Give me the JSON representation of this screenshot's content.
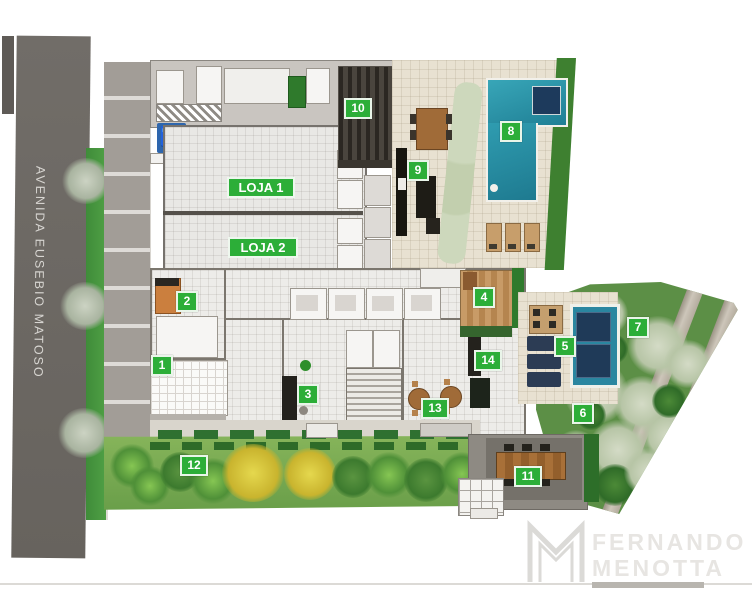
{
  "street": {
    "label": "AVENIDA EUSEBIO MATOSO"
  },
  "units": [
    {
      "label": "LOJA 1"
    },
    {
      "label": "LOJA 2"
    }
  ],
  "markers": [
    {
      "label": "1"
    },
    {
      "label": "2"
    },
    {
      "label": "3"
    },
    {
      "label": "4"
    },
    {
      "label": "5"
    },
    {
      "label": "6"
    },
    {
      "label": "7"
    },
    {
      "label": "8"
    },
    {
      "label": "9"
    },
    {
      "label": "10"
    },
    {
      "label": "11"
    },
    {
      "label": "12"
    },
    {
      "label": "13"
    },
    {
      "label": "14"
    }
  ],
  "icons": {
    "accessible_parking": "♿"
  },
  "watermark": {
    "line1": "FERNANDO",
    "line2": "MENOTTA"
  },
  "colors": {
    "marker_green": "#2cae38",
    "pool_teal": "#2a8ca3",
    "spa_navy": "#1f3a58",
    "road_gray": "#6e6a65",
    "lawn_green": "#6aa04c",
    "wood_brown": "#a06b38",
    "watermark_gray": "#e7e5e2",
    "handicap_blue": "#2e66ad"
  }
}
